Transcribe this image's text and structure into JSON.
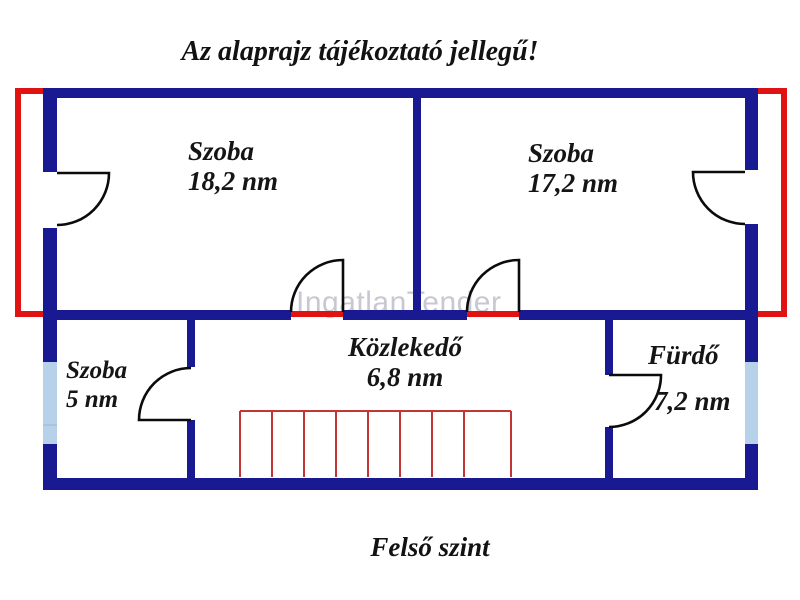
{
  "page": {
    "title": "Az alaprajz tájékoztató jellegű!",
    "floor_label": "Felső szint",
    "watermark": "IngatlanTender"
  },
  "rooms": [
    {
      "name": "Szoba",
      "area": "18,2 nm"
    },
    {
      "name": "Szoba",
      "area": "17,2 nm"
    },
    {
      "name": "Szoba",
      "area": "5 nm"
    },
    {
      "name": "Közlekedő",
      "area": "6,8 nm"
    },
    {
      "name": "Fürdő",
      "area": "7,2 nm"
    }
  ],
  "colors": {
    "wall": "#191991",
    "outline_red": "#e01212",
    "stairs_red": "#c03535",
    "window_blue": "#b7d1ea",
    "watermark_gray": "#c8c8d2",
    "text": "#121212",
    "background": "#ffffff"
  },
  "stairs": {
    "vertical_x": [
      240,
      272,
      304,
      336,
      368,
      400,
      432,
      464,
      511
    ],
    "top_y": 411,
    "bottom_y": 477,
    "left_x": 240,
    "right_x": 511
  }
}
